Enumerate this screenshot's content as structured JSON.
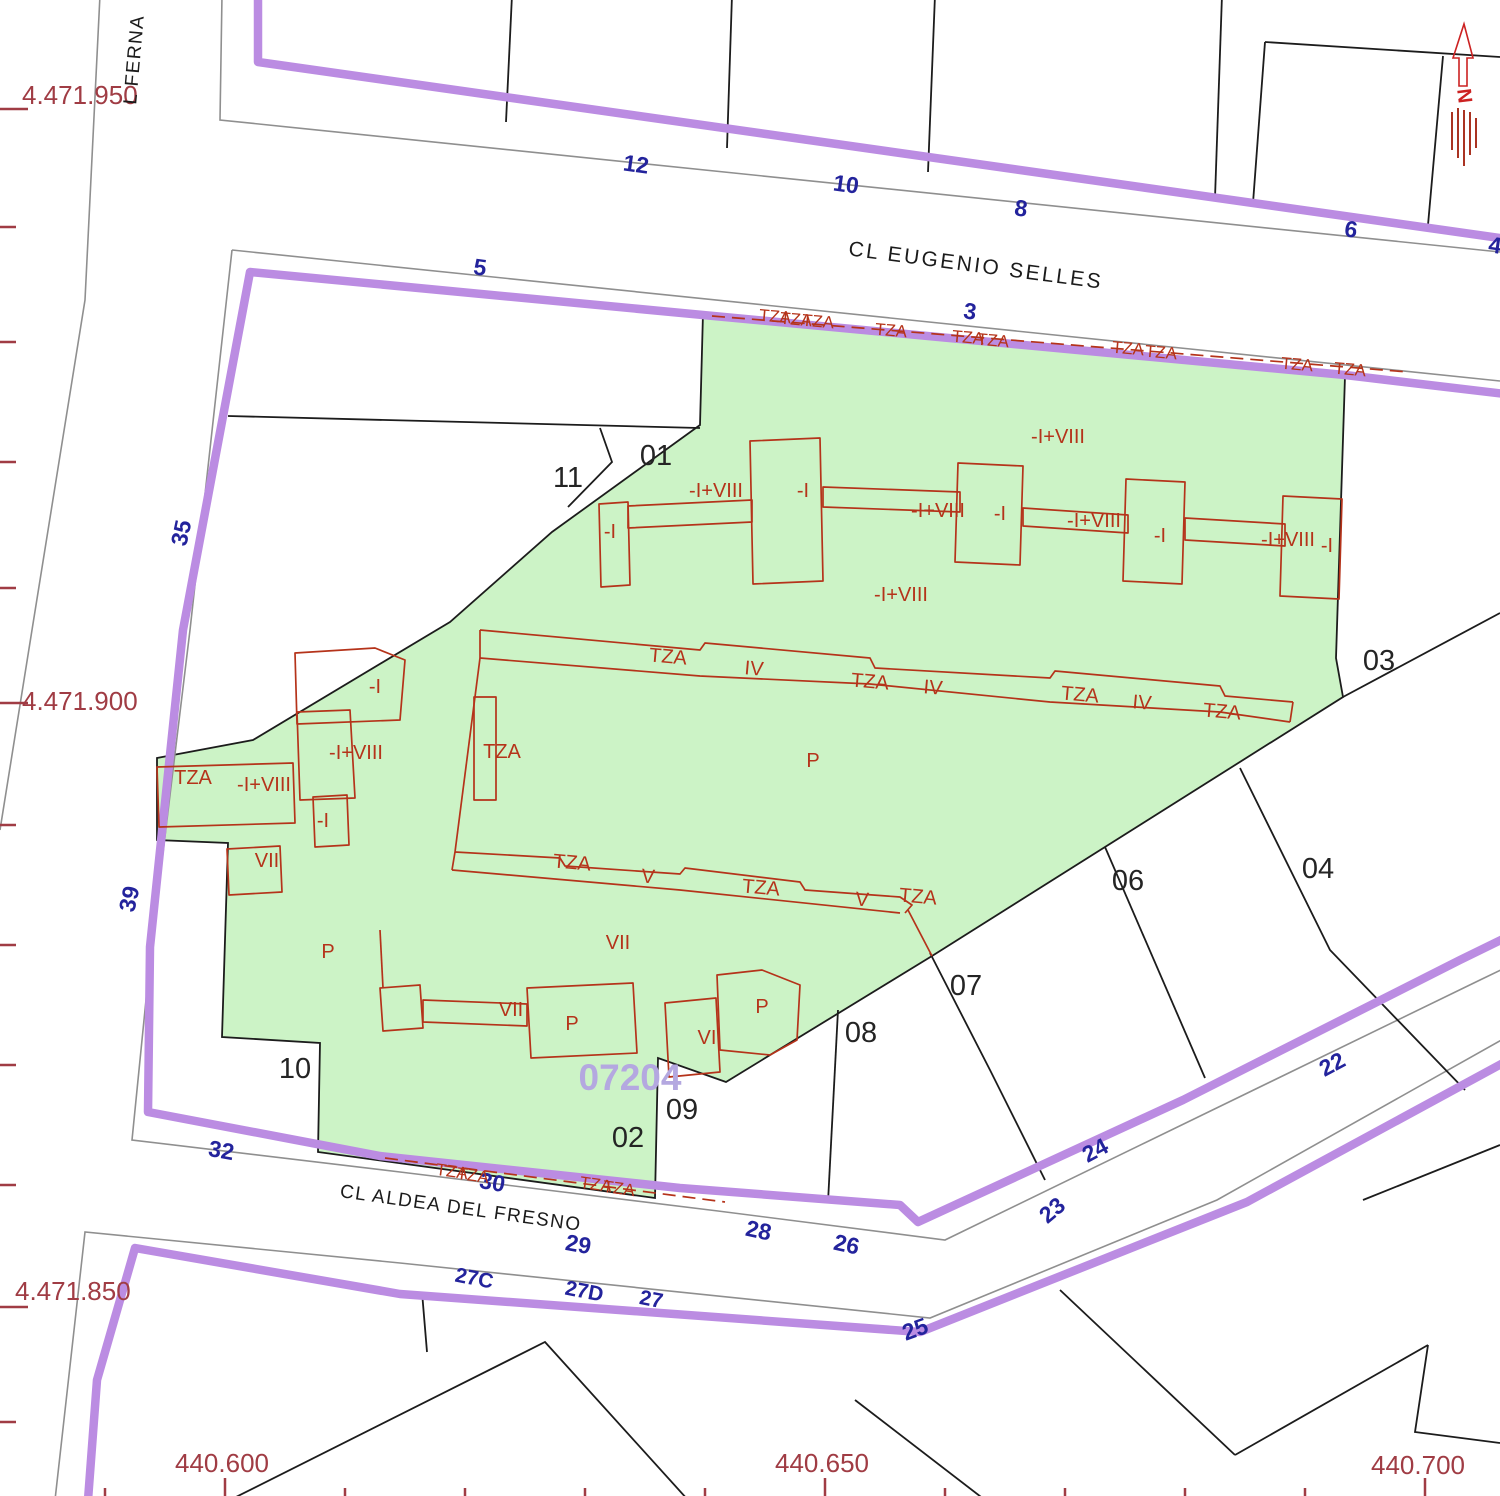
{
  "map": {
    "streets": {
      "top": "CL EUGENIO SELLES",
      "bottom": "CL ALDEA DEL FRESNO",
      "left": "L FERNA"
    },
    "grid": {
      "y": [
        "4.471.950",
        "4.471.900",
        "4.471.850"
      ],
      "x": [
        "440.600",
        "440.650",
        "440.700"
      ]
    },
    "parcel_id": "07204",
    "north_letter": "N",
    "parcels": {
      "p01": "01",
      "p02": "02",
      "p03": "03",
      "p04": "04",
      "p06": "06",
      "p07": "07",
      "p08": "08",
      "p09": "09",
      "p10": "10",
      "p11": "11"
    },
    "addresses": {
      "3": "3",
      "4": "4",
      "5": "5",
      "6": "6",
      "8": "8",
      "10": "10",
      "12": "12",
      "22": "22",
      "23": "23",
      "24": "24",
      "25": "25",
      "26": "26",
      "27": "27",
      "27C": "27C",
      "27D": "27D",
      "28": "28",
      "29": "29",
      "30": "30",
      "32": "32",
      "35": "35",
      "39": "39"
    },
    "bl": {
      "tza": "TZA",
      "iv": "IV",
      "v": "V",
      "vi": "VI",
      "vii": "VII",
      "p": "P",
      "b1": "-I",
      "b8": "-I+VIII"
    },
    "colors": {
      "parcel_fill": "#ccf3c6",
      "boundary_purple": "#bb8ce2",
      "building_red": "#b5331a",
      "address_blue": "#23239c",
      "coordinate_red": "#a03c44",
      "parcel_id_purple": "#b4a8e0",
      "street_gray": "#8f8f8f",
      "line_black": "#1c1c1c"
    }
  }
}
